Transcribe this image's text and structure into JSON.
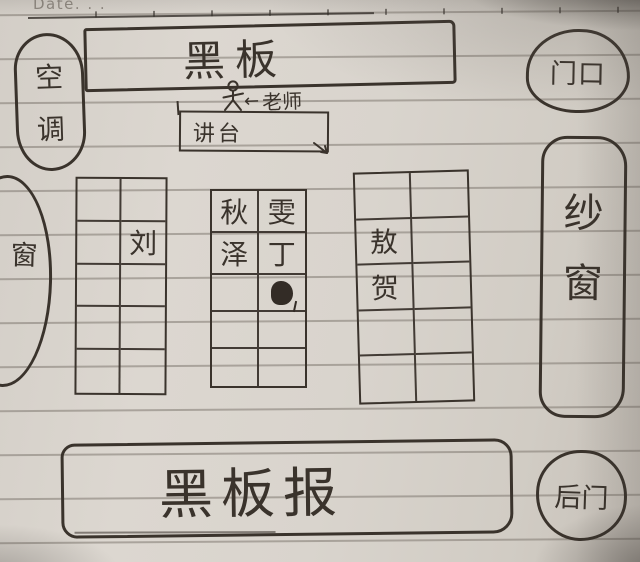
{
  "page": {
    "date_label": "Date. . ."
  },
  "labels": {
    "blackboard": "黑板",
    "teacher_arrow": "←",
    "teacher": "老师",
    "podium": "讲台",
    "air_conditioner": [
      "空",
      "调"
    ],
    "front_door": "门口",
    "left_window": "窗",
    "right_window": [
      "纱",
      "窗"
    ],
    "bulletin_board": "黑板报",
    "back_door": "后门"
  },
  "desk_groups": [
    {
      "name": "left-desk-column",
      "rows": 5,
      "cols": 2,
      "cells": [
        {
          "r": 2,
          "c": 2,
          "text": "刘"
        }
      ]
    },
    {
      "name": "middle-desk-column",
      "rows": 5,
      "cols": 2,
      "cells": [
        {
          "r": 1,
          "c": 1,
          "text": "秋"
        },
        {
          "r": 1,
          "c": 2,
          "text": "雯"
        },
        {
          "r": 2,
          "c": 1,
          "text": "泽"
        },
        {
          "r": 2,
          "c": 2,
          "text": "丁"
        },
        {
          "r": 3,
          "c": 2,
          "text": "",
          "scribbled": true
        }
      ]
    },
    {
      "name": "right-desk-column",
      "rows": 5,
      "cols": 2,
      "cells": [
        {
          "r": 2,
          "c": 1,
          "text": "敖"
        },
        {
          "r": 3,
          "c": 1,
          "text": "贺"
        }
      ]
    }
  ],
  "colors": {
    "paper": "#d9d4cd",
    "rule_line": "#837c74",
    "ink": "#3a332c",
    "date_text": "#8f8981"
  }
}
